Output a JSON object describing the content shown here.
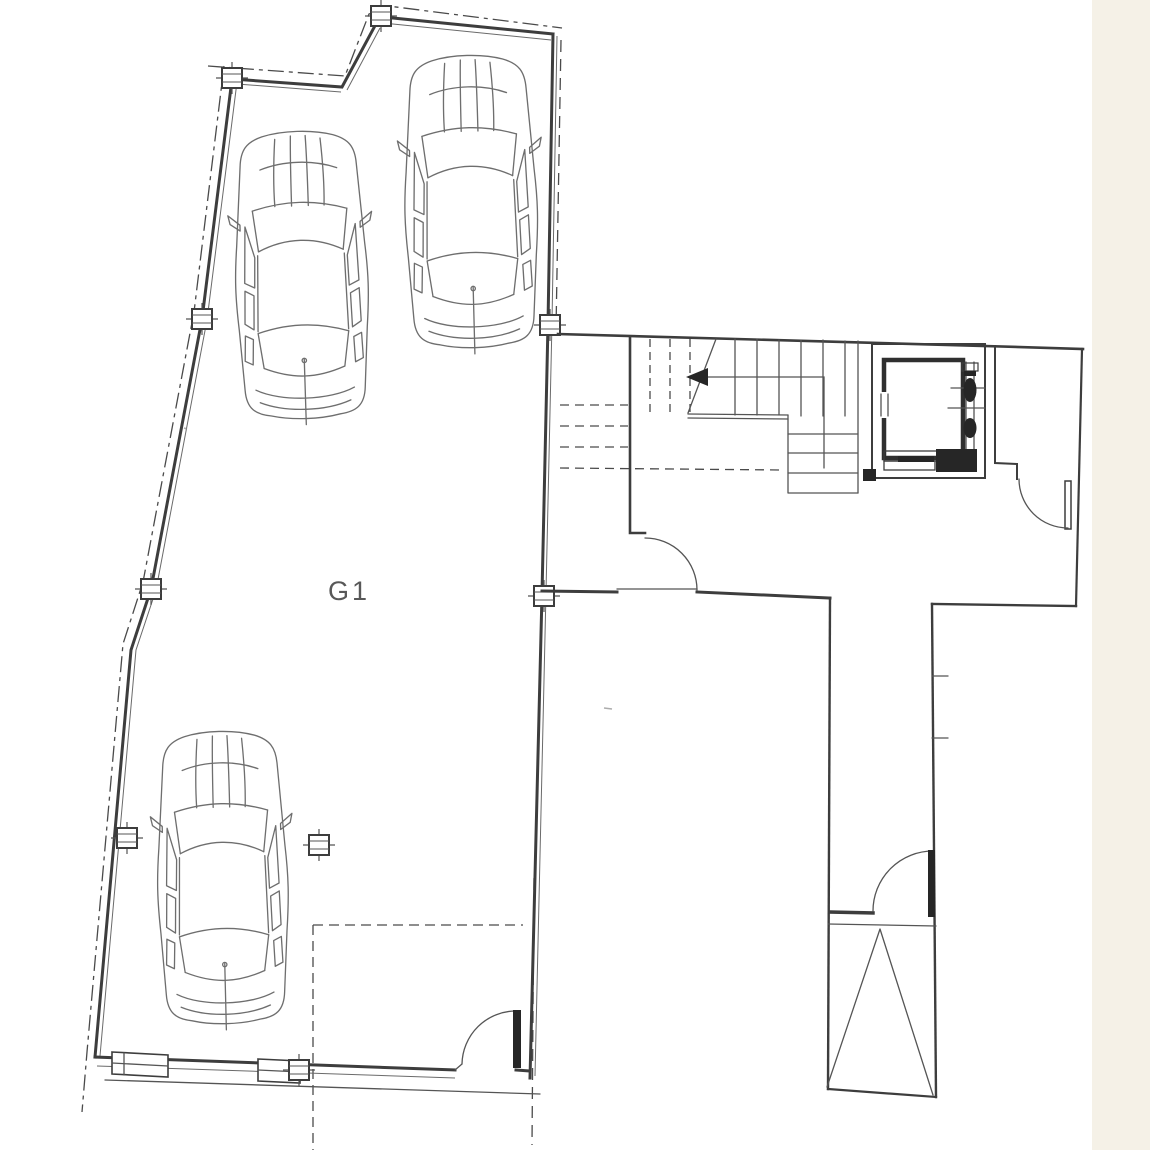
{
  "plan": {
    "room_label": "G1",
    "colors": {
      "paper": "#ffffff",
      "paper_edge": "#f5f1e7",
      "wall_line": "#3d3d3d",
      "thin_line": "#5a5a5a",
      "car_line": "#6e6e6e",
      "dark_fill": "#262626",
      "label_text": "#585858"
    },
    "legend": {
      "stair_arrow_direction": "left",
      "car_count": 3,
      "column_marker_count": 9,
      "door_count": 4,
      "boundary_style": "dash-dot-property-line"
    }
  }
}
